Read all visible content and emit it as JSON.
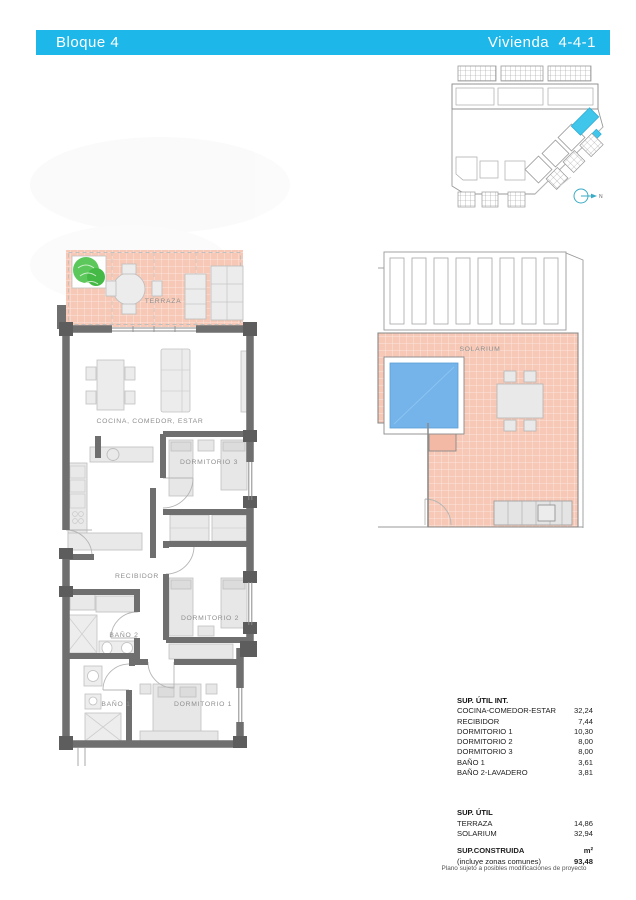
{
  "header": {
    "block_label": "Bloque 4",
    "unit_label": "Vivienda  4-4-1"
  },
  "site_plan": {
    "north_label": "N"
  },
  "floor_plan": {
    "rooms": {
      "terraza": "TERRAZA",
      "cocina": "COCINA, COMEDOR, ESTAR",
      "dormitorio3": "DORMITORIO 3",
      "recibidor": "RECIBIDOR",
      "dormitorio2": "DORMITORIO 2",
      "bano2": "BAÑO 2",
      "bano1": "BAÑO 1",
      "dormitorio1": "DORMITORIO 1"
    }
  },
  "solarium_plan": {
    "label": "SOLARIUM"
  },
  "area_table": {
    "int_title": "SUP. ÚTIL INT.",
    "int_rows": [
      {
        "label": "COCINA-COMEDOR-ESTAR",
        "value": "32,24"
      },
      {
        "label": "RECIBIDOR",
        "value": "7,44"
      },
      {
        "label": "DORMITORIO 1",
        "value": "10,30"
      },
      {
        "label": "DORMITORIO 2",
        "value": "8,00"
      },
      {
        "label": "DORMITORIO 3",
        "value": "8,00"
      },
      {
        "label": "BAÑO 1",
        "value": "3,61"
      },
      {
        "label": "BAÑO 2-LAVADERO",
        "value": "3,81"
      }
    ],
    "util_title": "SUP. ÚTIL",
    "util_rows": [
      {
        "label": "TERRAZA",
        "value": "14,86"
      },
      {
        "label": "SOLARIUM",
        "value": "32,94"
      }
    ],
    "built_label": "SUP.CONSTRUIDA",
    "built_unit": "m²",
    "built_note": "(incluye zonas comunes)",
    "built_value": "93,48"
  },
  "footer_note": "Plano sujeto a posibles modificaciones de proyecto",
  "colors": {
    "accent": "#1db7ea",
    "terrace_tile": "#f6c8b5",
    "pool": "#74b4ea",
    "plant": "#5cc85c",
    "wall": "#6f6f6f"
  }
}
